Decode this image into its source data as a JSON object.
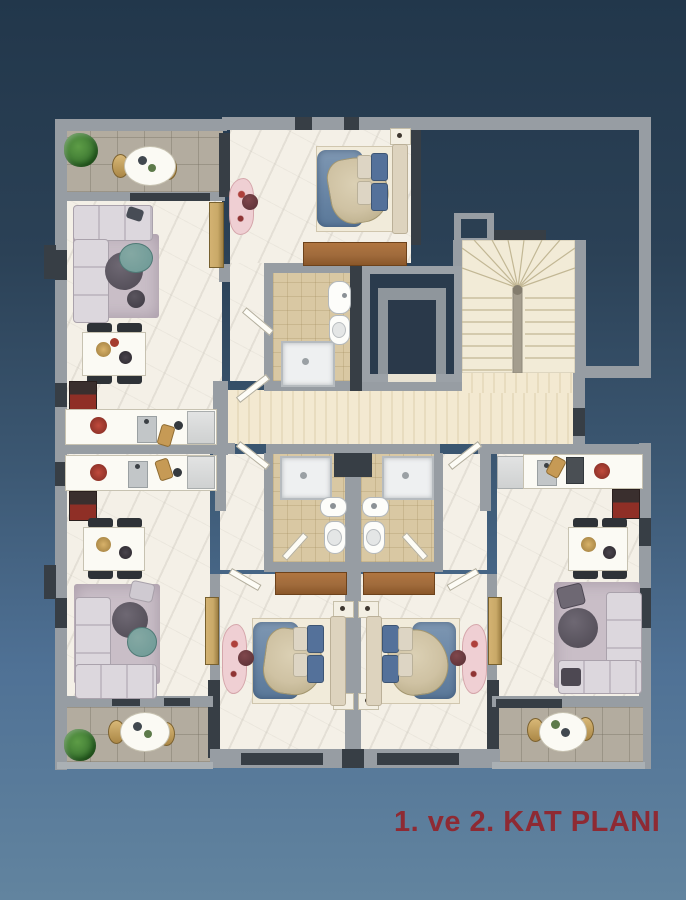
{
  "title": {
    "text": "1. ve 2. KAT PLANI"
  },
  "palette": {
    "bg-top": "#22374b",
    "bg-bottom": "#62849f",
    "wall": "#979da3",
    "wall-dark": "#373e45",
    "marble": "#f4f0e7",
    "bath-tile": "#d9c8a3",
    "corridor-a": "#f3e9d1",
    "corridor-b": "#e8dcbf",
    "balcony": "#b3ac9f",
    "sofa": "#dcd7dd",
    "rug": "#c9bec7",
    "wood": "#a06b3c",
    "teal": "#6d9996",
    "pink": "#efcfd3",
    "gold": "#c9a968",
    "stove-red": "#8f2f26",
    "plant": "#3e7a33",
    "bed-blue": "#6d89a8",
    "duvet": "#cfc2a3",
    "title-red": "#8e2a33"
  }
}
